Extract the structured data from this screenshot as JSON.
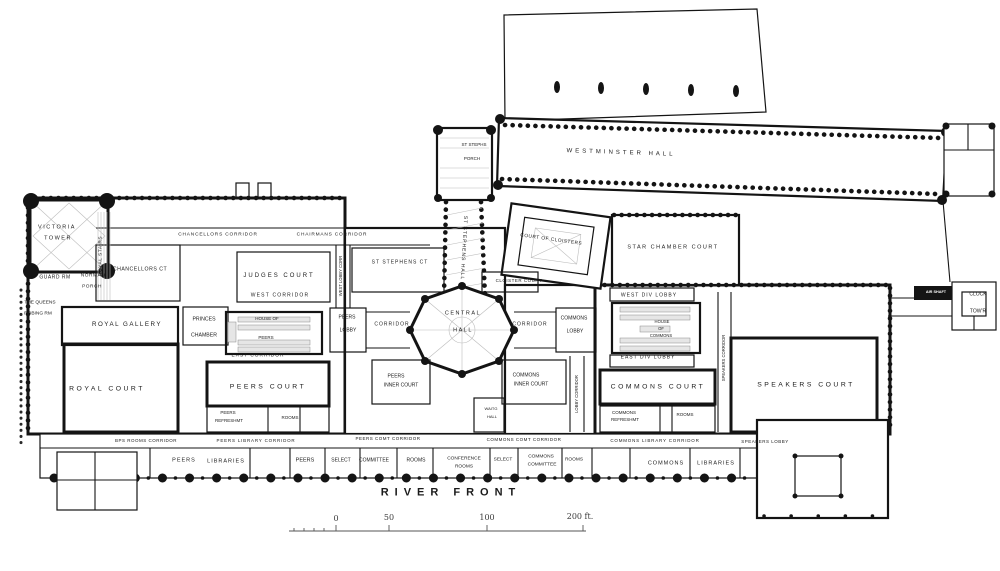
{
  "plan": {
    "subject": "Palace of Westminster principal floor plan",
    "ink": "#141414",
    "paper": "#ffffff"
  },
  "scale_bar": {
    "unit": "ft.",
    "tick_values": [
      0,
      50,
      100,
      200
    ]
  },
  "labels": [
    {
      "id": "victoria-tower-1",
      "t": "VICTORIA",
      "x": 57,
      "y": 228,
      "fs": 5.5,
      "ls": 1.5
    },
    {
      "id": "victoria-tower-2",
      "t": "TOWER",
      "x": 58,
      "y": 239,
      "fs": 5.5,
      "ls": 1.5
    },
    {
      "id": "guard-room",
      "t": "GUARD RM",
      "x": 55,
      "y": 278,
      "fs": 5,
      "ls": 0.5
    },
    {
      "id": "norman-porch-1",
      "t": "NORMAN",
      "x": 93,
      "y": 277,
      "fs": 4.8,
      "ls": 0.5
    },
    {
      "id": "norman-porch-2",
      "t": "PORCH",
      "x": 92,
      "y": 288,
      "fs": 4.8,
      "ls": 0.5
    },
    {
      "id": "royal-stairs",
      "t": "ROYAL STAIRS",
      "x": 102,
      "y": 256,
      "fs": 4.8,
      "rot": -90,
      "ls": 0.5
    },
    {
      "id": "queens-robing-1",
      "t": "THE QUEENS",
      "x": 40,
      "y": 304,
      "fs": 4.8
    },
    {
      "id": "queens-robing-2",
      "t": "ROBING RM",
      "x": 38,
      "y": 315,
      "fs": 4.8
    },
    {
      "id": "chancellors-court",
      "t": "CHANCELLORS CT",
      "x": 140,
      "y": 270,
      "fs": 5.2,
      "ls": 0.5
    },
    {
      "id": "chancellors-corridor",
      "t": "CHANCELLORS CORRIDOR",
      "x": 218,
      "y": 236,
      "fs": 4.8,
      "ls": 0.8
    },
    {
      "id": "chairmans-corridor",
      "t": "CHAIRMANS CORRIDOR",
      "x": 332,
      "y": 236,
      "fs": 4.8,
      "ls": 0.8
    },
    {
      "id": "judges-court",
      "t": "JUDGES COURT",
      "x": 279,
      "y": 276,
      "fs": 6,
      "ls": 2
    },
    {
      "id": "west-corridor",
      "t": "WEST CORRIDOR",
      "x": 280,
      "y": 296,
      "fs": 5,
      "ls": 1.2
    },
    {
      "id": "royal-gallery",
      "t": "ROYAL GALLERY",
      "x": 127,
      "y": 325,
      "fs": 6.2,
      "ls": 1.5
    },
    {
      "id": "princes-chamber-1",
      "t": "PRINCES",
      "x": 204,
      "y": 320,
      "fs": 5.2
    },
    {
      "id": "princes-chamber-2",
      "t": "CHAMBER",
      "x": 204,
      "y": 336,
      "fs": 5.2
    },
    {
      "id": "house-of-peers-1",
      "t": "HOUSE OF",
      "x": 267,
      "y": 319,
      "fs": 4.5
    },
    {
      "id": "house-of-peers-2",
      "t": "PEERS",
      "x": 266,
      "y": 338,
      "fs": 4.5
    },
    {
      "id": "east-corridor",
      "t": "EAST CORRIDOR",
      "x": 258,
      "y": 357,
      "fs": 4.8,
      "ls": 1
    },
    {
      "id": "royal-court",
      "t": "ROYAL COURT",
      "x": 107,
      "y": 390,
      "fs": 6.8,
      "ls": 2.5
    },
    {
      "id": "peers-court",
      "t": "PEERS COURT",
      "x": 268,
      "y": 388,
      "fs": 6.8,
      "ls": 2.5
    },
    {
      "id": "peers-refreshment-1",
      "t": "PEERS",
      "x": 228,
      "y": 413,
      "fs": 4.5
    },
    {
      "id": "peers-refreshment-2",
      "t": "REFRESHMT",
      "x": 229,
      "y": 421,
      "fs": 4.5
    },
    {
      "id": "peers-refreshment-rooms",
      "t": "ROOMS",
      "x": 290,
      "y": 418,
      "fs": 4.5
    },
    {
      "id": "bps-rooms-corridor",
      "t": "BPS ROOMS CORRIDOR",
      "x": 146,
      "y": 441,
      "fs": 4.5,
      "ls": 0.5
    },
    {
      "id": "peers-library-corridor",
      "t": "PEERS LIBRARY CORRIDOR",
      "x": 256,
      "y": 441,
      "fs": 4.5,
      "ls": 0.8
    },
    {
      "id": "peers-libraries-1",
      "t": "PEERS",
      "x": 184,
      "y": 461,
      "fs": 5.5,
      "ls": 1
    },
    {
      "id": "peers-libraries-2",
      "t": "LIBRARIES",
      "x": 226,
      "y": 462,
      "fs": 5.5,
      "ls": 1
    },
    {
      "id": "west-lobby-corridor",
      "t": "WEST LOBBY CORR",
      "x": 341,
      "y": 276,
      "fs": 4.2,
      "rot": -90
    },
    {
      "id": "peers-lobby-1",
      "t": "PEERS",
      "x": 347,
      "y": 318,
      "fs": 5
    },
    {
      "id": "peers-lobby-2",
      "t": "LOBBY",
      "x": 348,
      "y": 331,
      "fs": 5
    },
    {
      "id": "st-stephens-porch-1",
      "t": "ST STEPHS",
      "x": 474,
      "y": 145,
      "fs": 4.5
    },
    {
      "id": "st-stephens-porch-2",
      "t": "PORCH",
      "x": 472,
      "y": 159,
      "fs": 4.5
    },
    {
      "id": "st-stephens-hall",
      "t": "ST STEPHENS HALL",
      "x": 463,
      "y": 248,
      "fs": 5,
      "rot": 93,
      "ls": 1
    },
    {
      "id": "st-stephens-court",
      "t": "ST STEPHENS CT",
      "x": 400,
      "y": 263,
      "fs": 5,
      "ls": 1
    },
    {
      "id": "court-of-cloisters",
      "t": "COURT OF CLOISTERS",
      "x": 551,
      "y": 241,
      "fs": 4.8,
      "rot": 8,
      "ls": 0.5
    },
    {
      "id": "cloister-court",
      "t": "CLOISTER COURT",
      "x": 519,
      "y": 281,
      "fs": 4.5,
      "ls": 0.5
    },
    {
      "id": "central-hall-1",
      "t": "CENTRAL",
      "x": 463,
      "y": 314,
      "fs": 5.5,
      "ls": 1.5
    },
    {
      "id": "central-hall-2",
      "t": "HALL",
      "x": 463,
      "y": 331,
      "fs": 5.5,
      "ls": 1.5
    },
    {
      "id": "peers-corridor",
      "t": "CORRIDOR",
      "x": 392,
      "y": 325,
      "fs": 5,
      "ls": 1
    },
    {
      "id": "commons-corridor",
      "t": "CORRIDOR",
      "x": 530,
      "y": 325,
      "fs": 5,
      "ls": 1
    },
    {
      "id": "peers-inner-court-1",
      "t": "PEERS",
      "x": 396,
      "y": 377,
      "fs": 5
    },
    {
      "id": "peers-inner-court-2",
      "t": "INNER COURT",
      "x": 401,
      "y": 386,
      "fs": 5
    },
    {
      "id": "commons-inner-court-1",
      "t": "COMMONS",
      "x": 526,
      "y": 376,
      "fs": 5
    },
    {
      "id": "commons-inner-court-2",
      "t": "INNER COURT",
      "x": 531,
      "y": 385,
      "fs": 5
    },
    {
      "id": "waiting-hall-1",
      "t": "WAITG",
      "x": 491,
      "y": 409,
      "fs": 4
    },
    {
      "id": "waiting-hall-2",
      "t": "HALL",
      "x": 492,
      "y": 417,
      "fs": 4
    },
    {
      "id": "peers-committee-corridor",
      "t": "PEERS COMT CORRIDOR",
      "x": 388,
      "y": 439,
      "fs": 4.5,
      "ls": 0.5
    },
    {
      "id": "conference-rooms-1",
      "t": "CONFERENCE",
      "x": 464,
      "y": 460,
      "fs": 4.8
    },
    {
      "id": "conference-rooms-2",
      "t": "ROOMS",
      "x": 464,
      "y": 468,
      "fs": 4.8
    },
    {
      "id": "peers-room-bottom",
      "t": "PEERS",
      "x": 305,
      "y": 461,
      "fs": 5.5
    },
    {
      "id": "select-committee-1",
      "t": "SELECT",
      "x": 341,
      "y": 461,
      "fs": 5
    },
    {
      "id": "select-committee-2",
      "t": "COMMITTEE",
      "x": 374,
      "y": 461,
      "fs": 5
    },
    {
      "id": "select-committee-3",
      "t": "ROOMS",
      "x": 416,
      "y": 461,
      "fs": 5
    },
    {
      "id": "commons-committee-corridor",
      "t": "COMMONS COMT CORRIDOR",
      "x": 524,
      "y": 440,
      "fs": 4.5,
      "ls": 0.5
    },
    {
      "id": "commons-select-1",
      "t": "SELECT",
      "x": 503,
      "y": 461,
      "fs": 4.8
    },
    {
      "id": "commons-select-2",
      "t": "COMMONS",
      "x": 541,
      "y": 458,
      "fs": 4.8
    },
    {
      "id": "commons-select-3",
      "t": "COMMITTEE",
      "x": 542,
      "y": 466,
      "fs": 4.8
    },
    {
      "id": "commons-select-4",
      "t": "ROOMS",
      "x": 574,
      "y": 461,
      "fs": 4.8
    },
    {
      "id": "river-front",
      "t": "RIVER FRONT",
      "x": 451,
      "y": 493,
      "fs": 11,
      "ls": 6,
      "w": 700
    },
    {
      "id": "star-chamber-court",
      "t": "STAR CHAMBER COURT",
      "x": 673,
      "y": 248,
      "fs": 5.5,
      "ls": 1.5
    },
    {
      "id": "west-div-lobby",
      "t": "WEST DIV LOBBY",
      "x": 649,
      "y": 296,
      "fs": 5,
      "ls": 1
    },
    {
      "id": "commons-lobby-1",
      "t": "COMMONS",
      "x": 574,
      "y": 319,
      "fs": 5
    },
    {
      "id": "commons-lobby-2",
      "t": "LOBBY",
      "x": 575,
      "y": 332,
      "fs": 5
    },
    {
      "id": "house-of-commons-1",
      "t": "HOUSE",
      "x": 662,
      "y": 322,
      "fs": 4.2
    },
    {
      "id": "house-of-commons-2",
      "t": "OF",
      "x": 661,
      "y": 329,
      "fs": 4.2
    },
    {
      "id": "house-of-commons-3",
      "t": "COMMONS",
      "x": 661,
      "y": 336,
      "fs": 4.2
    },
    {
      "id": "east-div-lobby",
      "t": "EAST DIV LOBBY",
      "x": 648,
      "y": 358,
      "fs": 5,
      "ls": 1
    },
    {
      "id": "commons-court",
      "t": "COMMONS COURT",
      "x": 658,
      "y": 388,
      "fs": 6.8,
      "ls": 2.5
    },
    {
      "id": "commons-refreshment-1",
      "t": "COMMONS",
      "x": 624,
      "y": 413,
      "fs": 4.5
    },
    {
      "id": "commons-refreshment-2",
      "t": "REFRESHMT",
      "x": 625,
      "y": 420,
      "fs": 4.5
    },
    {
      "id": "commons-refreshment-rooms",
      "t": "ROOMS",
      "x": 685,
      "y": 415,
      "fs": 4.5
    },
    {
      "id": "lobby-corridor",
      "t": "LOBBY CORRIDOR",
      "x": 577,
      "y": 394,
      "fs": 4.2,
      "rot": -90
    },
    {
      "id": "speakers-corridor",
      "t": "SPEAKERS CORRIDOR",
      "x": 724,
      "y": 358,
      "fs": 4.2,
      "rot": -90
    },
    {
      "id": "commons-library-corridor",
      "t": "COMMONS LIBRARY CORRIDOR",
      "x": 655,
      "y": 441,
      "fs": 4.5,
      "ls": 0.8
    },
    {
      "id": "speakers-lobby",
      "t": "SPEAKERS LOBBY",
      "x": 765,
      "y": 442,
      "fs": 4.5,
      "ls": 0.5
    },
    {
      "id": "commons-libraries-1",
      "t": "COMMONS",
      "x": 666,
      "y": 464,
      "fs": 5.5,
      "ls": 1
    },
    {
      "id": "commons-libraries-2",
      "t": "LIBRARIES",
      "x": 716,
      "y": 464,
      "fs": 5.5,
      "ls": 1
    },
    {
      "id": "speakers-court",
      "t": "SPEAKERS COURT",
      "x": 806,
      "y": 386,
      "fs": 6.8,
      "ls": 2.5
    },
    {
      "id": "westminster-hall",
      "t": "WESTMINSTER HALL",
      "x": 621,
      "y": 153,
      "fs": 6,
      "ls": 3,
      "rot": 2
    },
    {
      "id": "air-shaft",
      "t": "AIR SHAFT",
      "x": 936,
      "y": 293,
      "fs": 3.8,
      "cls": "white"
    },
    {
      "id": "clock-tower-1",
      "t": "CLOCK",
      "x": 978,
      "y": 295,
      "fs": 5
    },
    {
      "id": "clock-tower-2",
      "t": "TOW'R",
      "x": 978,
      "y": 312,
      "fs": 5
    },
    {
      "id": "scale-0",
      "t": "0",
      "x": 336,
      "y": 519,
      "fs": 8,
      "cls": "scale"
    },
    {
      "id": "scale-50",
      "t": "50",
      "x": 389,
      "y": 518,
      "fs": 8,
      "cls": "scale"
    },
    {
      "id": "scale-100",
      "t": "100",
      "x": 487,
      "y": 518,
      "fs": 8,
      "cls": "scale"
    },
    {
      "id": "scale-200",
      "t": "200 ft.",
      "x": 580,
      "y": 517,
      "fs": 8,
      "cls": "scale"
    }
  ]
}
